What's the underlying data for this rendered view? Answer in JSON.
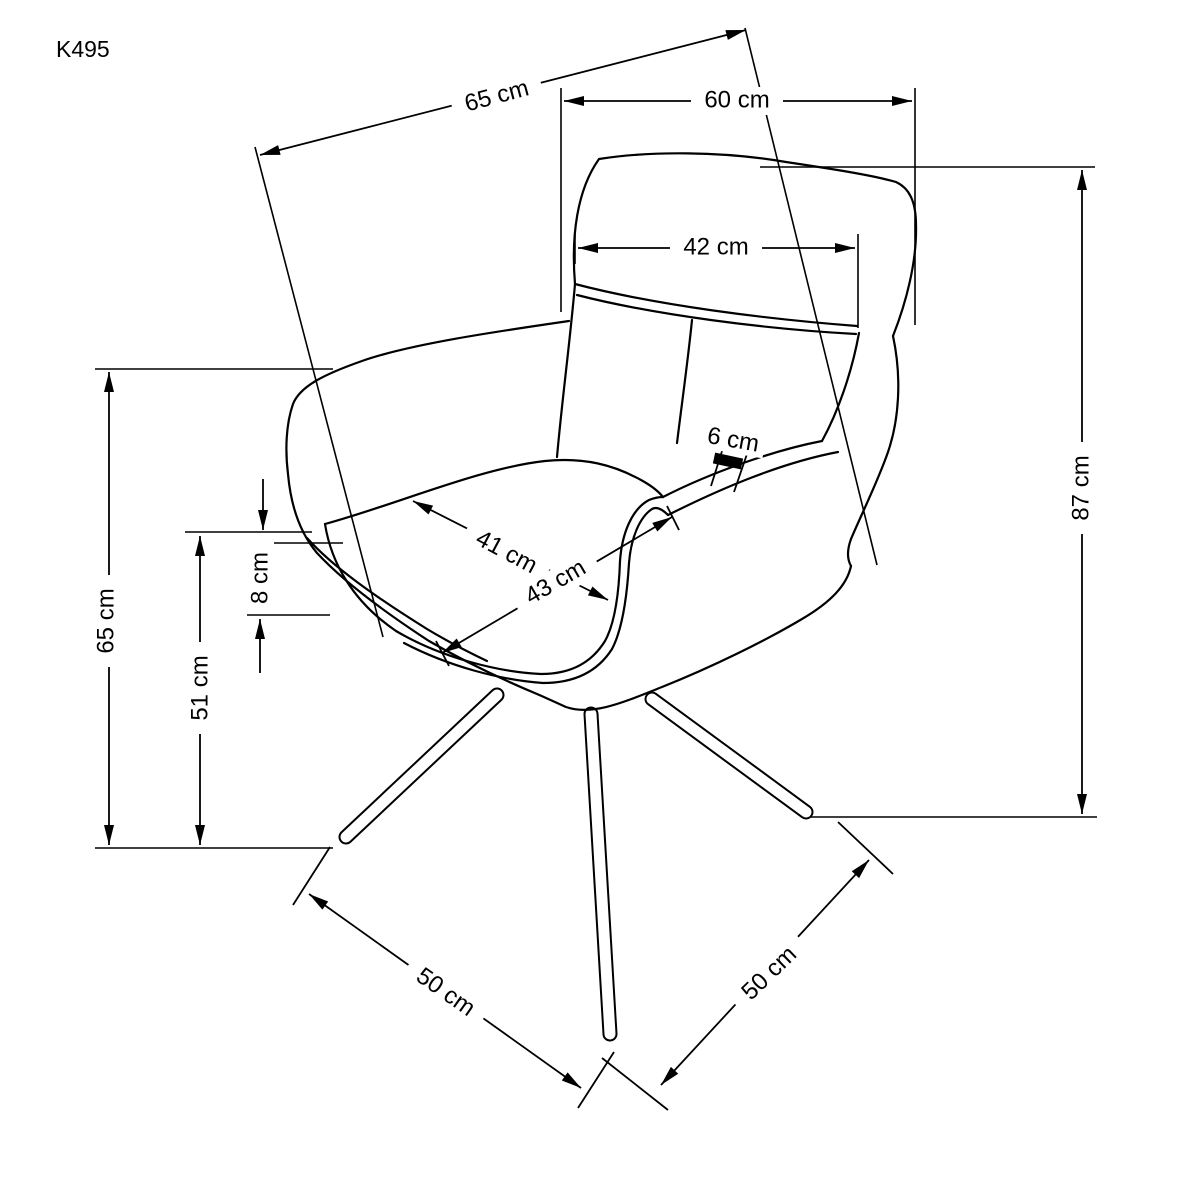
{
  "page": {
    "background_color": "#ffffff",
    "line_color": "#000000",
    "drawing_type": "furniture dimension diagram",
    "subject": "swivel armchair line drawing with dimension arrows",
    "unit": "cm"
  },
  "labels": {
    "model": "K495",
    "total_depth": "65 cm",
    "total_width": "60 cm",
    "backrest_width": "42 cm",
    "total_height": "87 cm",
    "armrest_height": "65 cm",
    "seat_height": "51 cm",
    "seat_side_height": "8 cm",
    "seat_depth": "41 cm",
    "seat_width": "43 cm",
    "cushion_edge_thickness": "6 cm",
    "leg_span_left": "50 cm",
    "leg_span_right": "50 cm"
  },
  "dimension_values": {
    "total_depth_cm": 65,
    "total_width_cm": 60,
    "backrest_width_cm": 42,
    "total_height_cm": 87,
    "armrest_height_cm": 65,
    "seat_height_cm": 51,
    "seat_side_height_cm": 8,
    "seat_depth_cm": 41,
    "seat_width_cm": 43,
    "cushion_edge_thickness_cm": 6,
    "leg_span_left_cm": 50,
    "leg_span_right_cm": 50
  }
}
